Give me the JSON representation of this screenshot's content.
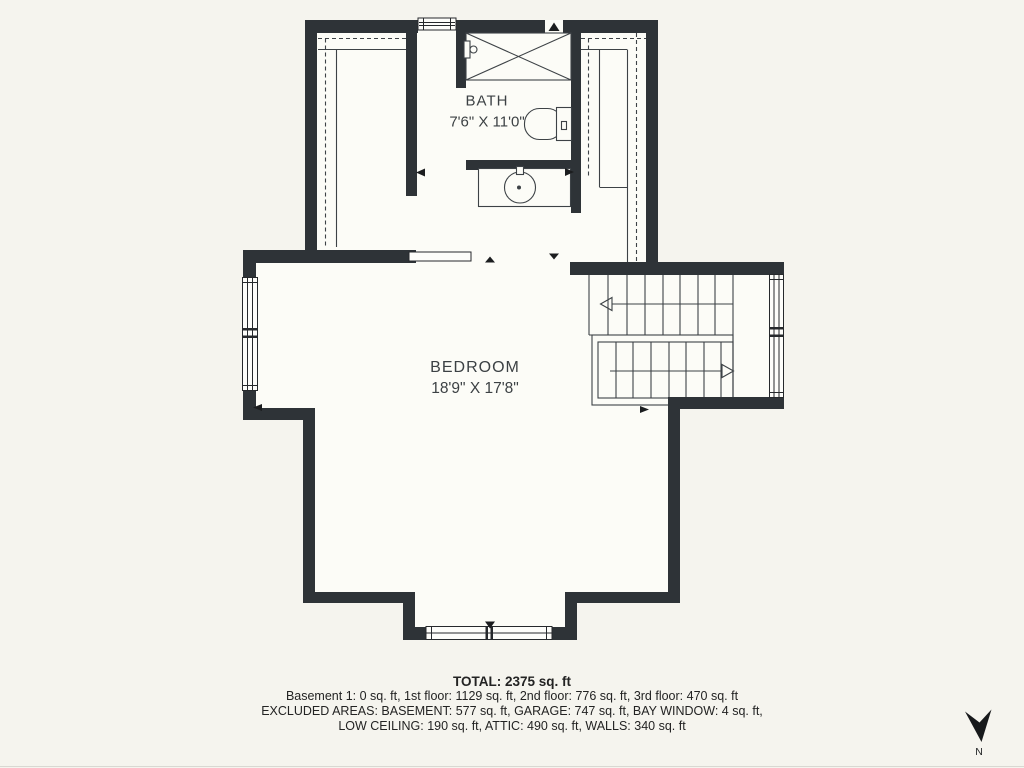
{
  "floorplan": {
    "rooms": {
      "bath": {
        "label": "BATH",
        "dimensions": "7'6\" X 11'0\""
      },
      "bedroom": {
        "label": "BEDROOM",
        "dimensions": "18'9\" X 17'8\""
      }
    },
    "summary": {
      "total": "TOTAL: 2375 sq. ft",
      "floors": "Basement 1: 0 sq. ft, 1st floor: 1129 sq. ft, 2nd floor: 776 sq. ft, 3rd floor: 470 sq. ft",
      "excluded_line1": "EXCLUDED AREAS: BASEMENT: 577 sq. ft, GARAGE: 747 sq. ft, BAY WINDOW: 4 sq. ft,",
      "excluded_line2": "LOW CEILING: 190 sq. ft, ATTIC: 490 sq. ft, WALLS: 340 sq. ft"
    },
    "compass": {
      "label": "N"
    },
    "colors": {
      "wall": "#2e3337",
      "line": "#3d4246",
      "background": "#f5f4ee",
      "room_fill": "#fcfcf7",
      "text": "#3c4144",
      "summary_text": "#232323"
    }
  }
}
